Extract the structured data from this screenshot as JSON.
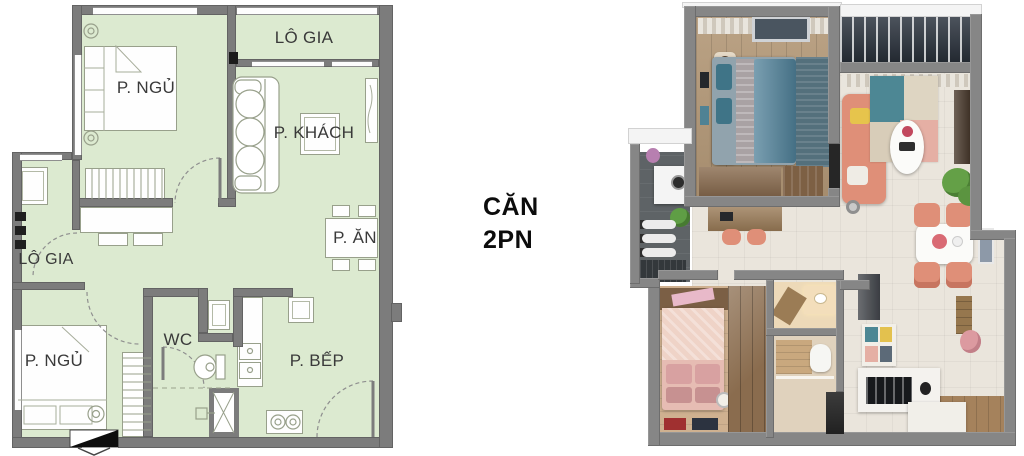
{
  "unit_label": {
    "line1": "CĂN",
    "line2": "2PN"
  },
  "plan_2d": {
    "rooms": [
      {
        "id": "bedroom-1",
        "label": "P. NGỦ"
      },
      {
        "id": "loggia-top",
        "label": "LÔ GIA"
      },
      {
        "id": "living-room",
        "label": "P. KHÁCH"
      },
      {
        "id": "dining-area",
        "label": "P. ĂN"
      },
      {
        "id": "loggia-left",
        "label": "LÔ GIA"
      },
      {
        "id": "bedroom-2",
        "label": "P. NGỦ"
      },
      {
        "id": "bathroom",
        "label": "WC"
      },
      {
        "id": "kitchen",
        "label": "P. BẾP"
      }
    ],
    "colors": {
      "floor": "#dcead0",
      "walls": "#7c7c7c",
      "furniture_outline": "#98a08b",
      "text": "#3a3a3a"
    }
  },
  "plan_3d": {
    "colors": {
      "walls": "#868686",
      "wood_floor": "#b39877",
      "tile_floor": "#eae5dc",
      "sofa": "#df8f78",
      "master_bed": "#557f96",
      "second_bed": "#e6bcb3",
      "pergola": "#2d3540",
      "plant": "#64a047",
      "dining_chair": "#dd8872"
    }
  }
}
